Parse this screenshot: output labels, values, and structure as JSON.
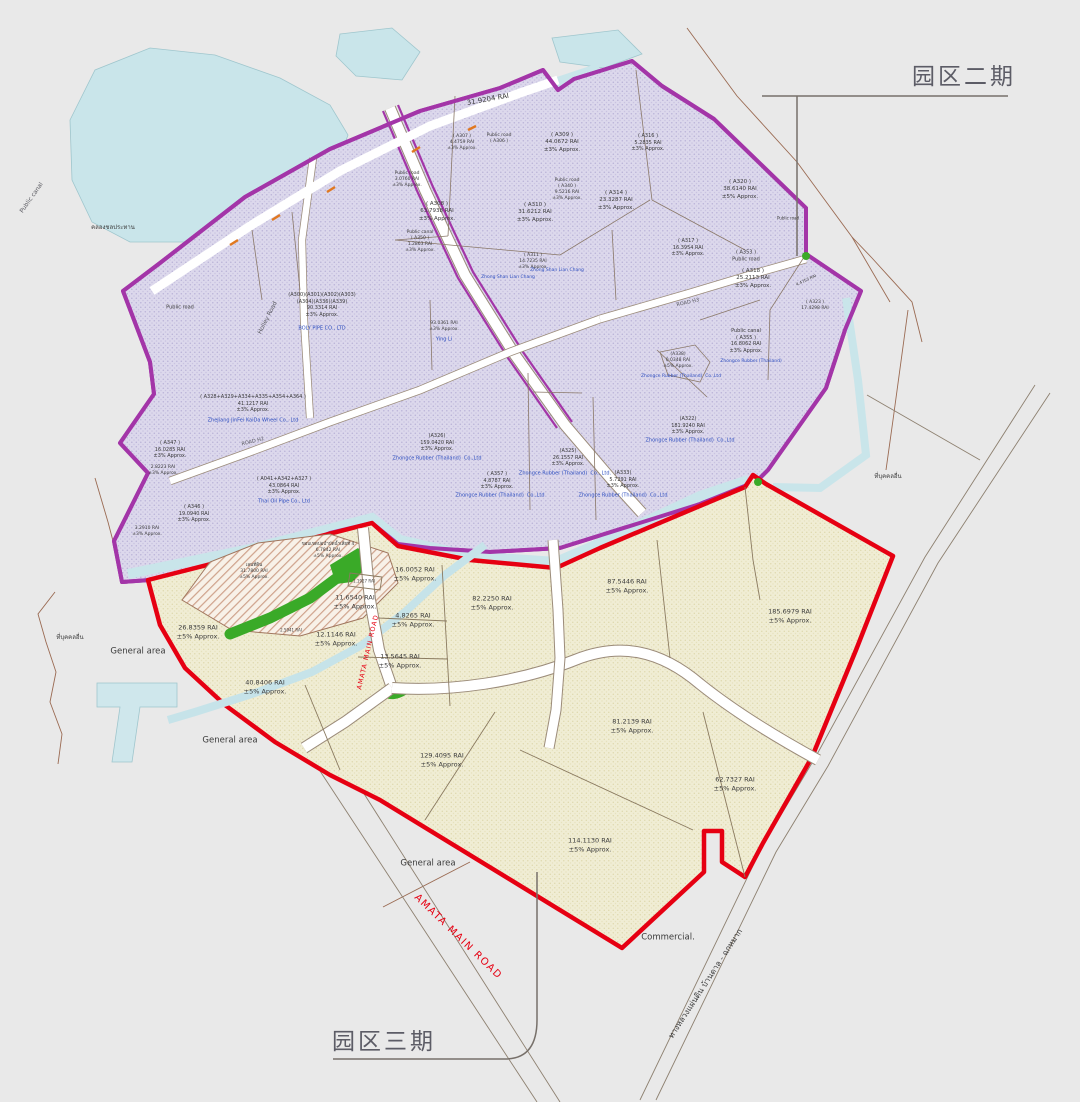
{
  "phase2_title": "园区二期",
  "phase3_title": "园区三期",
  "colors": {
    "phase2_boundary": "#a335a8",
    "phase2_fill": "#dcd8ec",
    "phase3_boundary": "#e60012",
    "phase3_fill": "#f0edd4",
    "water": "#c9e5ea",
    "green_area": "#3aaa28",
    "company_blue": "#3050c0",
    "road_red_label": "#e60012",
    "background": "#e9e9e9"
  },
  "labels": [
    {
      "id": "rai-31-9204",
      "lines": [
        "31.9204 RAI"
      ],
      "x": 488,
      "y": 100,
      "s": 7,
      "rot": -10
    },
    {
      "id": "a307",
      "lines": [
        "( A307 )",
        "4.4759 RAI",
        "±3% Approx."
      ],
      "x": 462,
      "y": 143,
      "s": 4.5
    },
    {
      "id": "a306-public-road",
      "lines": [
        "Public road",
        "( A306 )"
      ],
      "x": 499,
      "y": 139,
      "s": 4.5
    },
    {
      "id": "a309",
      "lines": [
        "( A309 )",
        "44.0672 RAI",
        "±3% Approx."
      ],
      "x": 562,
      "y": 143,
      "s": 5.5
    },
    {
      "id": "a316",
      "lines": [
        "( A316 )",
        "5.2835 RAI",
        "±3% Approx."
      ],
      "x": 648,
      "y": 143,
      "s": 5
    },
    {
      "id": "a320",
      "lines": [
        "( A320 )",
        "38.6140 RAI",
        "±5% Approx."
      ],
      "x": 740,
      "y": 190,
      "s": 5.5
    },
    {
      "id": "public-road-3-0760",
      "lines": [
        "Public road",
        "3.0760 RAI",
        "±3% Approx."
      ],
      "x": 407,
      "y": 180,
      "s": 4.5
    },
    {
      "id": "a308",
      "lines": [
        "( A308 )",
        "63.7938 RAI",
        "±3% Approx."
      ],
      "x": 437,
      "y": 212,
      "s": 5.5
    },
    {
      "id": "a340",
      "lines": [
        "Public road",
        "( A340 )",
        "9.5216 RAI",
        "±3% Approx."
      ],
      "x": 567,
      "y": 190,
      "s": 4.5
    },
    {
      "id": "a314",
      "lines": [
        "( A314 )",
        "23.3287 RAI",
        "±3% Approx."
      ],
      "x": 616,
      "y": 201,
      "s": 5.5
    },
    {
      "id": "a310",
      "lines": [
        "( A310 )",
        "31.6212 RAI",
        "±3% Approx."
      ],
      "x": 535,
      "y": 213,
      "s": 5.5
    },
    {
      "id": "a350",
      "lines": [
        "Public canal",
        "( A350 )",
        "1.2863 RAI",
        "±3% Approx."
      ],
      "x": 420,
      "y": 242,
      "s": 4.5
    },
    {
      "id": "a311",
      "lines": [
        "( A311 )",
        "14.7235 RAI",
        "±3% Approx."
      ],
      "x": 533,
      "y": 262,
      "s": 4.5
    },
    {
      "id": "zslc-1",
      "lines": [
        "Zhong Shan Lian Chang"
      ],
      "x": 557,
      "y": 271,
      "s": 4.5,
      "c": "b"
    },
    {
      "id": "zslc-2",
      "lines": [
        "Zhong Shan Lian Chang"
      ],
      "x": 508,
      "y": 278,
      "s": 4.5,
      "c": "b"
    },
    {
      "id": "a317",
      "lines": [
        "( A317 )",
        "16.3954 RAI",
        "±3% Approx."
      ],
      "x": 688,
      "y": 248,
      "s": 5
    },
    {
      "id": "a353",
      "lines": [
        "( A353 )",
        "Public road"
      ],
      "x": 746,
      "y": 256,
      "s": 5
    },
    {
      "id": "a318",
      "lines": [
        "( A318 )",
        "25.2113 RAI",
        "±3% Approx."
      ],
      "x": 753,
      "y": 279,
      "s": 5.5
    },
    {
      "id": "a323",
      "lines": [
        "( A323 )",
        "17.4298 RAI"
      ],
      "x": 815,
      "y": 306,
      "s": 4.5
    },
    {
      "id": "rai-4-4753",
      "lines": [
        "4.4753 RAI"
      ],
      "x": 806,
      "y": 280,
      "s": 4,
      "rot": -25
    },
    {
      "id": "public-road-ne",
      "lines": [
        "Public road"
      ],
      "x": 788,
      "y": 218,
      "s": 4
    },
    {
      "id": "boly-block",
      "lines": [
        "(A300)(A301)(A302)(A303)",
        "(A304)(A336)(A339)",
        "90.3314 RAI",
        "±3% Approx."
      ],
      "x": 322,
      "y": 305,
      "s": 5
    },
    {
      "id": "boly-name",
      "lines": [
        "BOLY PIPE CO., LTD"
      ],
      "x": 322,
      "y": 329,
      "s": 5,
      "c": "b"
    },
    {
      "id": "public-road-w",
      "lines": [
        "Public road"
      ],
      "x": 180,
      "y": 308,
      "s": 5
    },
    {
      "id": "jinfei-block",
      "lines": [
        "( A328+A329+A334+A335+A354+A364 )",
        "41.1217 RAI",
        "±3% Approx."
      ],
      "x": 253,
      "y": 404,
      "s": 5
    },
    {
      "id": "jinfei-name",
      "lines": [
        "ZheJiang JinFei KaiDa Wheel Co., Ltd"
      ],
      "x": 253,
      "y": 421,
      "s": 5,
      "c": "b"
    },
    {
      "id": "a347",
      "lines": [
        "( A347 )",
        "16.0285 RAI",
        "±3% Approx."
      ],
      "x": 170,
      "y": 450,
      "s": 5
    },
    {
      "id": "rai-2-8223",
      "lines": [
        "2.8223 RAI",
        "±3% Approx."
      ],
      "x": 163,
      "y": 471,
      "s": 4.5
    },
    {
      "id": "a346",
      "lines": [
        "( A346 )",
        "19.0940 RAI",
        "±3% Approx."
      ],
      "x": 194,
      "y": 514,
      "s": 5
    },
    {
      "id": "rai-3-2910",
      "lines": [
        "3.2910 RAI",
        "±3% Approx."
      ],
      "x": 147,
      "y": 532,
      "s": 4.5
    },
    {
      "id": "thaioil-block",
      "lines": [
        "( A041+A342+A327 )",
        "43.0864 RAI",
        "±3% Approx."
      ],
      "x": 284,
      "y": 486,
      "s": 5
    },
    {
      "id": "thaioil-name",
      "lines": [
        "Thai Oil Pipe Co., Ltd"
      ],
      "x": 284,
      "y": 502,
      "s": 5,
      "c": "b"
    },
    {
      "id": "yingli-block",
      "lines": [
        "93.0361 RAI",
        "±3% Approx."
      ],
      "x": 444,
      "y": 327,
      "s": 4.5
    },
    {
      "id": "yingli-name",
      "lines": [
        "Ying Li"
      ],
      "x": 444,
      "y": 340,
      "s": 5,
      "c": "b"
    },
    {
      "id": "a326",
      "lines": [
        "(A326)",
        "159.0420 RAI",
        "±3% Approx."
      ],
      "x": 437,
      "y": 443,
      "s": 5
    },
    {
      "id": "zhongce-a326",
      "lines": [
        "Zhongce Rubber (Thailand)  Co.,Ltd"
      ],
      "x": 437,
      "y": 459,
      "s": 5,
      "c": "b"
    },
    {
      "id": "a325",
      "lines": [
        "(A325)",
        "26.1557 RAI",
        "±3% Approx."
      ],
      "x": 568,
      "y": 458,
      "s": 5
    },
    {
      "id": "zhongce-a325",
      "lines": [
        "Zhongce Rubber (Thailand)  Co., Ltd."
      ],
      "x": 565,
      "y": 474,
      "s": 5,
      "c": "b"
    },
    {
      "id": "a357",
      "lines": [
        "( A357 )",
        "4.8787 RAI",
        "±3% Approx."
      ],
      "x": 497,
      "y": 481,
      "s": 5
    },
    {
      "id": "zhongce-a357",
      "lines": [
        "Zhongce Rubber (Thailand)  Co.,Ltd"
      ],
      "x": 500,
      "y": 496,
      "s": 5,
      "c": "b"
    },
    {
      "id": "a333",
      "lines": [
        "(A333)",
        "5.7291 RAI",
        "±3% Approx."
      ],
      "x": 623,
      "y": 480,
      "s": 5
    },
    {
      "id": "zhongce-a333",
      "lines": [
        "Zhongce Rubber (Thailand)  Co.,Ltd"
      ],
      "x": 623,
      "y": 496,
      "s": 5,
      "c": "b"
    },
    {
      "id": "a322",
      "lines": [
        "(A322)",
        "181.9240 RAI",
        "±3% Approx."
      ],
      "x": 688,
      "y": 426,
      "s": 5
    },
    {
      "id": "zhongce-a322",
      "lines": [
        "Zhongce Rubber (Thailand)  Co.,Ltd"
      ],
      "x": 690,
      "y": 441,
      "s": 5,
      "c": "b"
    },
    {
      "id": "a338",
      "lines": [
        "(A338)",
        "0.0348 RAI",
        "±5% Approx."
      ],
      "x": 678,
      "y": 361,
      "s": 4.5
    },
    {
      "id": "zhongce-a338",
      "lines": [
        "Zhongce Rubber (Thailand)  Co.,Ltd"
      ],
      "x": 681,
      "y": 377,
      "s": 4.5,
      "c": "b"
    },
    {
      "id": "a355",
      "lines": [
        "Public canal",
        "( A355 )",
        "16.8062 RAI",
        "±3% Approx."
      ],
      "x": 746,
      "y": 341,
      "s": 5
    },
    {
      "id": "zhongce-a355",
      "lines": [
        "Zhongce Rubber (Thailand)"
      ],
      "x": 751,
      "y": 362,
      "s": 4.5,
      "c": "b"
    },
    {
      "id": "holley-road",
      "lines": [
        "Holley Road"
      ],
      "x": 268,
      "y": 318,
      "s": 6,
      "c": "g",
      "rot": -63
    },
    {
      "id": "road-h2",
      "lines": [
        "ROAD H2"
      ],
      "x": 253,
      "y": 442,
      "s": 5,
      "c": "g",
      "rot": -14
    },
    {
      "id": "road-h3",
      "lines": [
        "ROAD H3"
      ],
      "x": 688,
      "y": 303,
      "s": 5,
      "c": "g",
      "rot": -13
    },
    {
      "id": "public-canal-left",
      "lines": [
        "Public canal"
      ],
      "x": 32,
      "y": 198,
      "s": 6,
      "c": "g",
      "rot": -55
    },
    {
      "id": "rai-26-8359",
      "lines": [
        "26.8359 RAI",
        "±5% Approx."
      ],
      "x": 198,
      "y": 632,
      "s": 6.5
    },
    {
      "id": "rai-40-8406",
      "lines": [
        "40.8406 RAI",
        "±5% Approx."
      ],
      "x": 265,
      "y": 687,
      "s": 6.5
    },
    {
      "id": "rai-11-6540",
      "lines": [
        "11.6540 RAI",
        "±5% Approx."
      ],
      "x": 355,
      "y": 602,
      "s": 6.5
    },
    {
      "id": "rai-12-1146",
      "lines": [
        "12.1146 RAI",
        "±5% Approx."
      ],
      "x": 336,
      "y": 639,
      "s": 6.5
    },
    {
      "id": "rai-16-0052",
      "lines": [
        "16.0052 RAI",
        "±5% Approx."
      ],
      "x": 415,
      "y": 574,
      "s": 6.5
    },
    {
      "id": "rai-4-8265",
      "lines": [
        "4.8265 RAI",
        "±5% Approx."
      ],
      "x": 413,
      "y": 620,
      "s": 6.5
    },
    {
      "id": "rai-13-5645",
      "lines": [
        "13.5645 RAI",
        "±5% Approx."
      ],
      "x": 400,
      "y": 661,
      "s": 6.5
    },
    {
      "id": "rai-82-2250",
      "lines": [
        "82.2250 RAI",
        "±5% Approx."
      ],
      "x": 492,
      "y": 603,
      "s": 6.5
    },
    {
      "id": "rai-87-5446",
      "lines": [
        "87.5446 RAI",
        "±5% Approx."
      ],
      "x": 627,
      "y": 586,
      "s": 6.5
    },
    {
      "id": "rai-185-6979",
      "lines": [
        "185.6979 RAI",
        "±5% Approx."
      ],
      "x": 790,
      "y": 616,
      "s": 6.5
    },
    {
      "id": "rai-81-2139",
      "lines": [
        "81.2139 RAI",
        "±5% Approx."
      ],
      "x": 632,
      "y": 726,
      "s": 6.5
    },
    {
      "id": "rai-62-7327",
      "lines": [
        "62.7327 RAI",
        "±5% Approx."
      ],
      "x": 735,
      "y": 784,
      "s": 6.5
    },
    {
      "id": "rai-129-4095",
      "lines": [
        "129.4095 RAI",
        "±5% Approx."
      ],
      "x": 442,
      "y": 760,
      "s": 6.5
    },
    {
      "id": "rai-114-1130",
      "lines": [
        "114.1130 RAI",
        "±5% Approx."
      ],
      "x": 590,
      "y": 845,
      "s": 6.5
    },
    {
      "id": "rai-1-1927",
      "lines": [
        "1.1927 RAI"
      ],
      "x": 364,
      "y": 581,
      "s": 4
    },
    {
      "id": "rai-2-5941",
      "lines": [
        "2.5941 RAI"
      ],
      "x": 291,
      "y": 630,
      "s": 4
    },
    {
      "id": "pond-note",
      "lines": [
        "ขอบเขตบ่อบำบัดน้ำเสียที่ 4",
        "6.7842 RAI",
        "±5% Approx."
      ],
      "x": 328,
      "y": 551,
      "s": 4.5
    },
    {
      "id": "pond-area",
      "lines": [
        "เลนที่ดิน",
        "31.7800 RAI",
        "±5% Approx."
      ],
      "x": 254,
      "y": 572,
      "s": 4.5
    },
    {
      "id": "general-area-1",
      "lines": [
        "General area"
      ],
      "x": 138,
      "y": 652,
      "s": 8.5
    },
    {
      "id": "general-area-2",
      "lines": [
        "General area"
      ],
      "x": 230,
      "y": 741,
      "s": 8.5
    },
    {
      "id": "general-area-3",
      "lines": [
        "General area"
      ],
      "x": 428,
      "y": 864,
      "s": 8.5
    },
    {
      "id": "commercial",
      "lines": [
        "Commercial."
      ],
      "x": 668,
      "y": 938,
      "s": 8.5
    },
    {
      "id": "amata-main-road-vertical",
      "lines": [
        "AMATA MAIN ROAD"
      ],
      "x": 368,
      "y": 652,
      "s": 6.5,
      "c": "r",
      "rot": -77,
      "ls": 1
    },
    {
      "id": "amata-main-road",
      "lines": [
        "AMATA MAIN ROAD"
      ],
      "x": 458,
      "y": 937,
      "s": 10,
      "c": "r",
      "rot": 44,
      "ls": 1.5
    },
    {
      "id": "thai-highway",
      "lines": [
        "ทางหลวงแผ่นดิน บ้านดาล - ฉกหมาก"
      ],
      "x": 706,
      "y": 984,
      "s": 8,
      "rot": -57
    },
    {
      "id": "thai-other-land-right",
      "lines": [
        "ที่บุคคลอื่น"
      ],
      "x": 888,
      "y": 477,
      "s": 6
    },
    {
      "id": "thai-other-land-left",
      "lines": [
        "ที่บุคคลอื่น"
      ],
      "x": 70,
      "y": 638,
      "s": 6
    },
    {
      "id": "thai-canal",
      "lines": [
        "คลองชลประทาน"
      ],
      "x": 113,
      "y": 228,
      "s": 6
    }
  ]
}
